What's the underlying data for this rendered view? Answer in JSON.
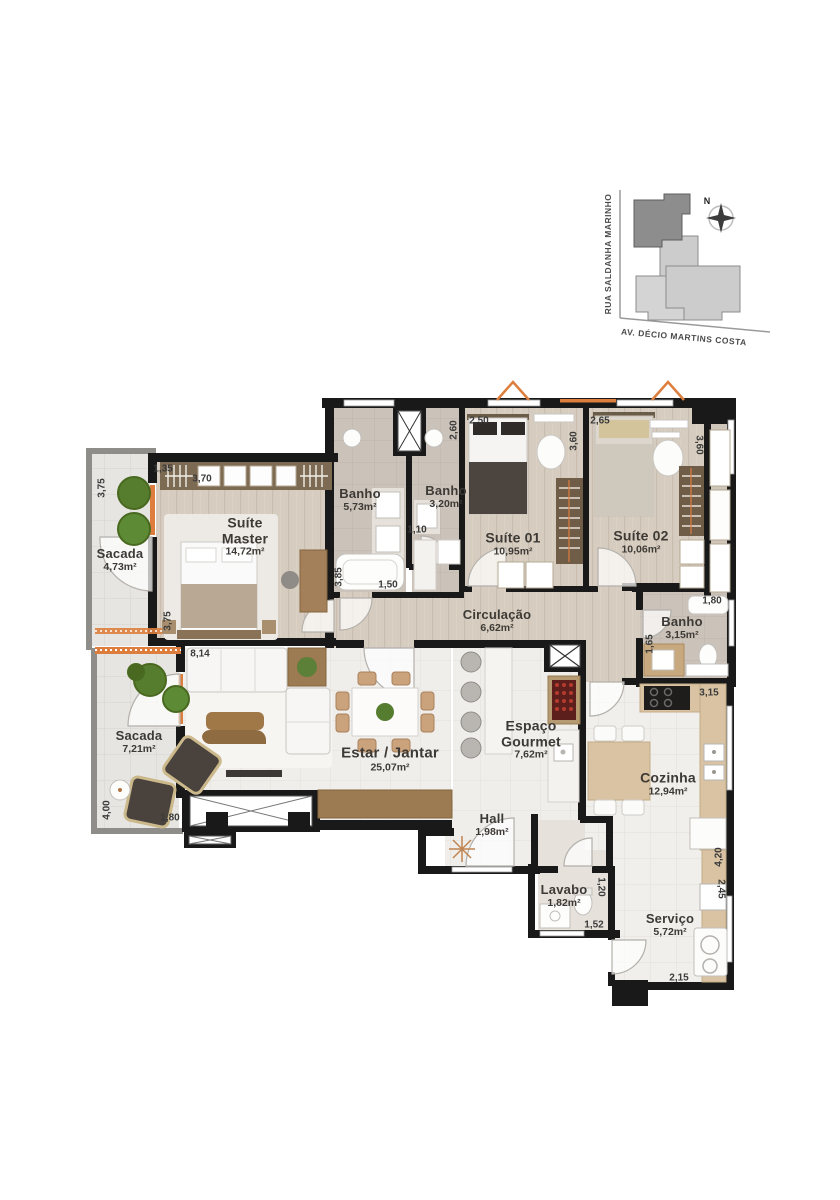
{
  "palette": {
    "wall": "#191919",
    "accent_orange": "#dd7e3e",
    "wood_floor": "#d6ccbf",
    "tile_floor": "#f0eeeb",
    "balcony_floor": "#e7e5e2",
    "site_building_highlight": "#8d8d8d",
    "site_building_light": "#cccccc"
  },
  "site_map": {
    "street_left": "RUA SALDANHA MARINHO",
    "street_bottom": "AV. DÉCIO MARTINS COSTA",
    "compass": "N"
  },
  "rooms": [
    {
      "id": "sacada-top",
      "lines": [
        "Sacada"
      ],
      "area": "4,73m²"
    },
    {
      "id": "suite-master",
      "lines": [
        "Suíte",
        "Master"
      ],
      "area": "14,72m²"
    },
    {
      "id": "banho-suite-master",
      "lines": [
        "Banho"
      ],
      "area": "5,73m²"
    },
    {
      "id": "banho-social",
      "lines": [
        "Banho"
      ],
      "area": "3,20m²"
    },
    {
      "id": "suite-01",
      "lines": [
        "Suíte 01"
      ],
      "area": "10,95m²"
    },
    {
      "id": "suite-02",
      "lines": [
        "Suíte 02"
      ],
      "area": "10,06m²"
    },
    {
      "id": "circulacao",
      "lines": [
        "Circulação"
      ],
      "area": "6,62m²"
    },
    {
      "id": "banho-suite-02",
      "lines": [
        "Banho"
      ],
      "area": "3,15m²"
    },
    {
      "id": "sacada-estar",
      "lines": [
        "Sacada"
      ],
      "area": "7,21m²"
    },
    {
      "id": "estar-jantar",
      "lines": [
        "Estar / Jantar"
      ],
      "area": "25,07m²"
    },
    {
      "id": "espaco-gourmet",
      "lines": [
        "Espaço",
        "Gourmet"
      ],
      "area": "7,62m²"
    },
    {
      "id": "hall",
      "lines": [
        "Hall"
      ],
      "area": "1,98m²"
    },
    {
      "id": "cozinha",
      "lines": [
        "Cozinha"
      ],
      "area": "12,94m²"
    },
    {
      "id": "lavabo",
      "lines": [
        "Lavabo"
      ],
      "area": "1,82m²"
    },
    {
      "id": "servico",
      "lines": [
        "Serviço"
      ],
      "area": "5,72m²"
    }
  ],
  "dimensions": [
    {
      "value": "3,75"
    },
    {
      "value": "1,35"
    },
    {
      "value": "3,70"
    },
    {
      "value": "3,75"
    },
    {
      "value": "8,14"
    },
    {
      "value": "2,60"
    },
    {
      "value": "2,50"
    },
    {
      "value": "3,60"
    },
    {
      "value": "2,65"
    },
    {
      "value": "3,60"
    },
    {
      "value": "1,10"
    },
    {
      "value": "3,85"
    },
    {
      "value": "1,50"
    },
    {
      "value": "1,80"
    },
    {
      "value": "1,65"
    },
    {
      "value": "3,15"
    },
    {
      "value": "4,00"
    },
    {
      "value": "1,80"
    },
    {
      "value": "4,20"
    },
    {
      "value": "2,45"
    },
    {
      "value": "1,20"
    },
    {
      "value": "1,52"
    },
    {
      "value": "2,15"
    }
  ]
}
